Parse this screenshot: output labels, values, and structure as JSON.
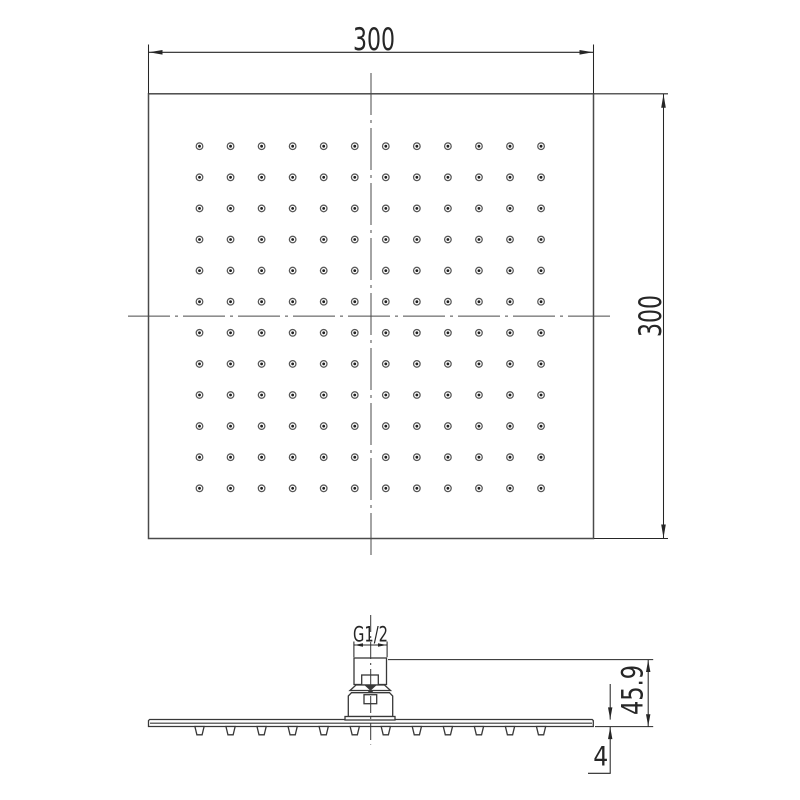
{
  "top_view": {
    "width_dimension": "300",
    "height_dimension": "300",
    "nozzle_grid": {
      "cols": 12,
      "rows": 12
    }
  },
  "side_view": {
    "thread_dimension": "G1/2",
    "total_height_dimension": "45.9",
    "plate_thickness_dimension": "4",
    "nozzle_count": 12
  },
  "colors": {
    "background": "#ffffff",
    "outline": "#4a4a4a",
    "side_outline": "#383838",
    "dimension": "#262626",
    "dot_ring": "#575757",
    "dot_core": "#1f1f1f"
  }
}
